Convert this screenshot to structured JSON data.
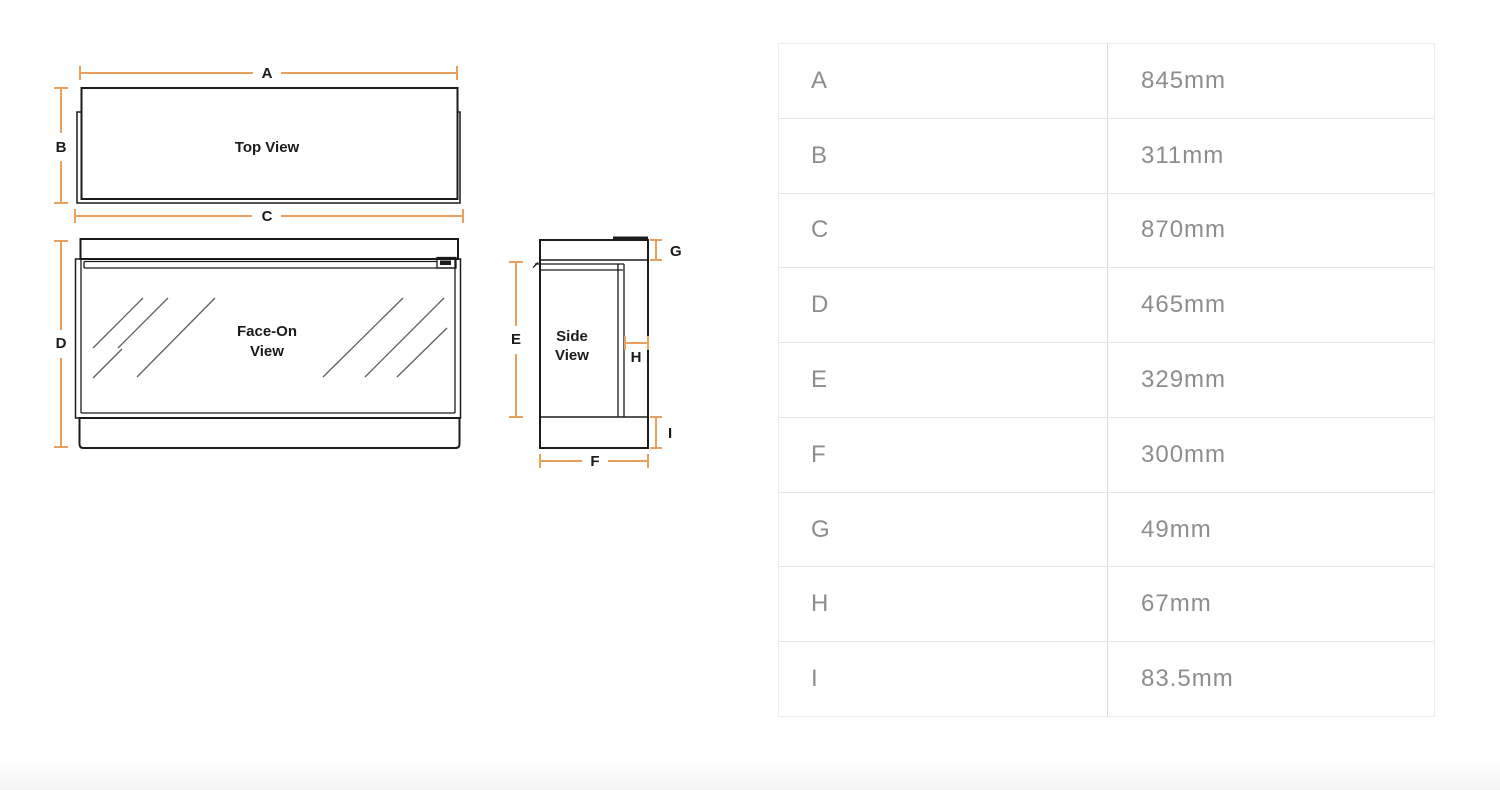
{
  "diagram": {
    "views": {
      "top_label": "Top View",
      "face_line1": "Face-On",
      "face_line2": "View",
      "side_line1": "Side",
      "side_line2": "View"
    },
    "dims": {
      "a": "A",
      "b": "B",
      "c": "C",
      "d": "D",
      "e": "E",
      "f": "F",
      "g": "G",
      "h": "H",
      "i": "I"
    },
    "colors": {
      "dimension_line": "#E8A05C",
      "outline": "#1B1B1B",
      "glass_reflection": "#5F5F5F"
    }
  },
  "table": {
    "rows": [
      {
        "label": "A",
        "value": "845mm"
      },
      {
        "label": "B",
        "value": "311mm"
      },
      {
        "label": "C",
        "value": "870mm"
      },
      {
        "label": "D",
        "value": "465mm"
      },
      {
        "label": "E",
        "value": "329mm"
      },
      {
        "label": "F",
        "value": "300mm"
      },
      {
        "label": "G",
        "value": "49mm"
      },
      {
        "label": "H",
        "value": "67mm"
      },
      {
        "label": "I",
        "value": "83.5mm"
      }
    ],
    "text_color": "#8D8D8D",
    "divider_color": "#D9D9D9",
    "row_border_color": "#E6E6E6"
  }
}
